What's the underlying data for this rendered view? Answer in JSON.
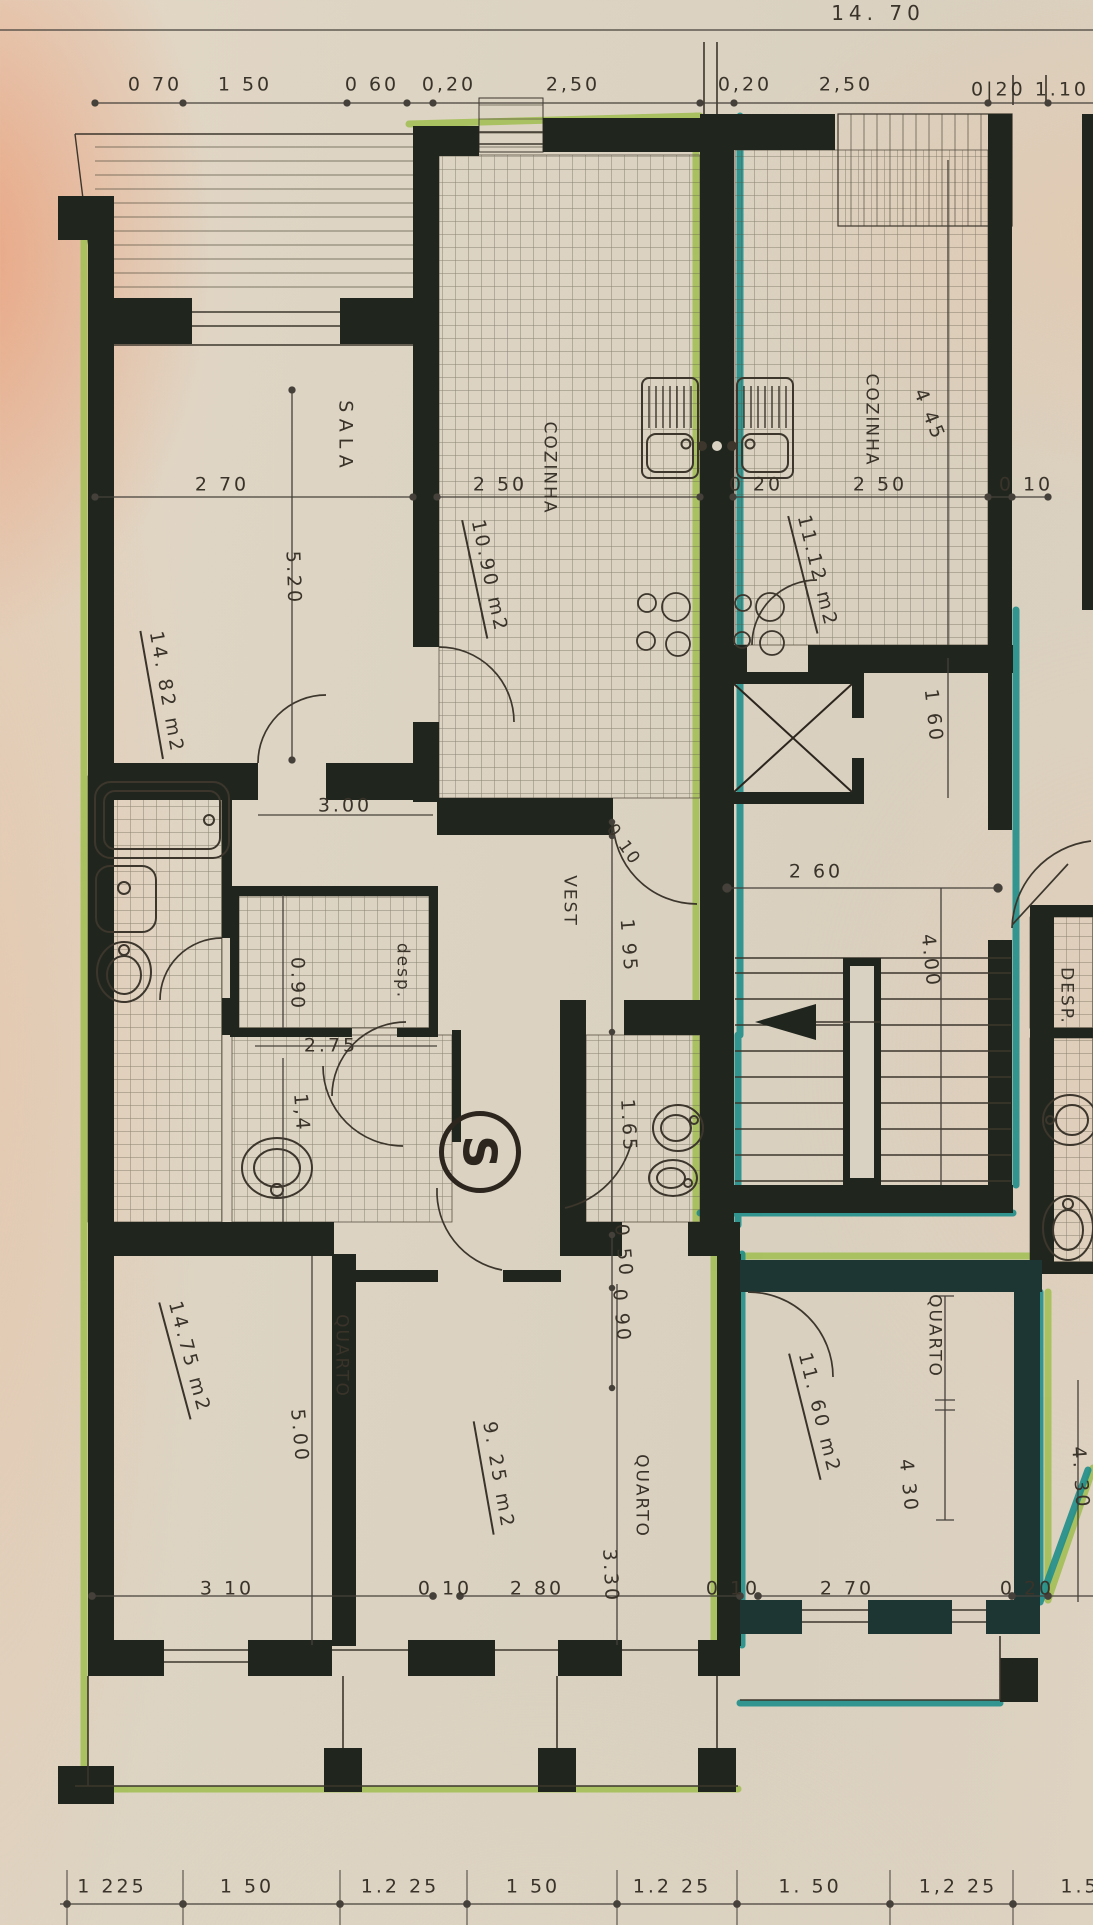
{
  "plan": {
    "symbol": "S"
  },
  "colors": {
    "paper": "#ddd4c3",
    "wall_ink": "#20261e",
    "line_ink": "#45403a",
    "left_unit_highlight": "#a3bf55",
    "right_unit_highlight": "#1f8e8a"
  },
  "dims": {
    "total": "14. 70",
    "top_row": [
      "0 70",
      "1 50",
      "0 60",
      "0,20",
      "2,50",
      "0,20",
      "2,50",
      "0|20 1.10"
    ],
    "mid_row": [
      "2 70",
      "2 50",
      "0 20",
      "2 50",
      "0 10"
    ],
    "lower_row": [
      "3 10",
      "0 10",
      "2 80",
      "0 10",
      "2 70",
      "0 20"
    ],
    "bottom_row": [
      "1 225",
      "1 50",
      "1.2 25",
      "1 50",
      "1.2 25",
      "1. 50",
      "1,2 25",
      "1.5"
    ]
  },
  "left_unit": {
    "sala": {
      "name": "SALA",
      "depth": "5.20",
      "area": "14. 82 m2",
      "wall_dim": "3.00"
    },
    "cozinha": {
      "name": "COZINHA",
      "area": "10.90 m2"
    },
    "vest": {
      "name": "VEST",
      "gap": "0 10",
      "depth": "1 95"
    },
    "desp": {
      "name": "desp.",
      "width": "0.90",
      "length": "2.75",
      "width2": "1,4"
    },
    "bath": {
      "width": "1.65",
      "d2": "0 50",
      "d3": "0 90"
    },
    "quarto1": {
      "name": "QUARTO",
      "area": "14.75 m2",
      "depth": "5.00"
    },
    "quarto2": {
      "name": "QUARTO",
      "area": "9. 25 m2",
      "depth": "3.30"
    }
  },
  "right_unit": {
    "cozinha": {
      "name": "COZINHA",
      "area": "11.12 m2",
      "depth": "4 45",
      "d2": "1 60"
    },
    "core": {
      "width": "2 60",
      "depth": "4.00"
    },
    "quarto": {
      "name": "QUARTO",
      "area": "11. 60 m2",
      "depth": "4 30"
    }
  },
  "far_right_unit": {
    "desp_name": "DESP.",
    "quarto_depth": "4. 30"
  }
}
